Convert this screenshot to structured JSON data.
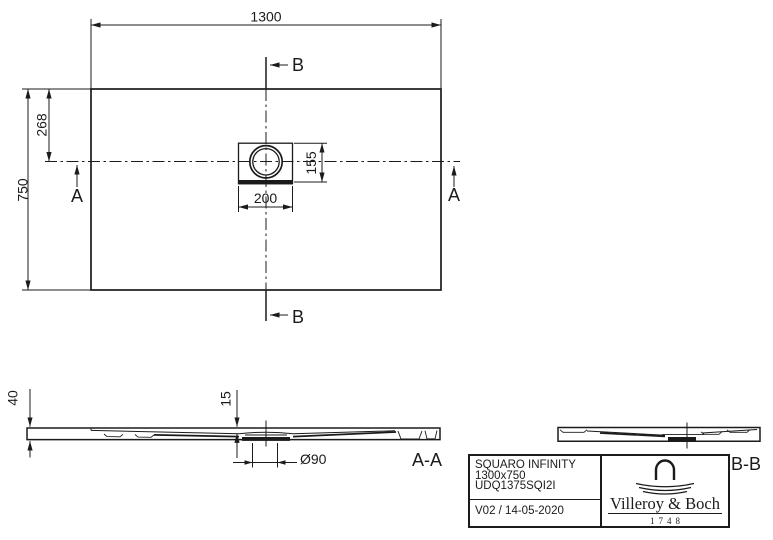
{
  "colors": {
    "line_color": "#1b1b1b",
    "background": "#ffffff"
  },
  "plan_view": {
    "dim_overall_width": "1300",
    "dim_overall_depth": "750",
    "dim_drain_offset_from_top": "268",
    "dim_drain_box_depth": "155",
    "dim_drain_box_width": "200",
    "section_marker_a": "A",
    "section_marker_b": "B"
  },
  "section_aa": {
    "label": "A-A",
    "dim_edge_thickness": "40",
    "dim_recess_depth": "15",
    "dim_drain_diameter": "Ø90"
  },
  "section_bb": {
    "label": "B-B"
  },
  "title_block": {
    "product_name": "SQUARO INFINITY",
    "size": "1300x750",
    "article_code": "UDQ1375SQI2I",
    "revision_date": "V02 / 14-05-2020",
    "brand_name": "Villeroy & Boch",
    "brand_year": "1748"
  }
}
